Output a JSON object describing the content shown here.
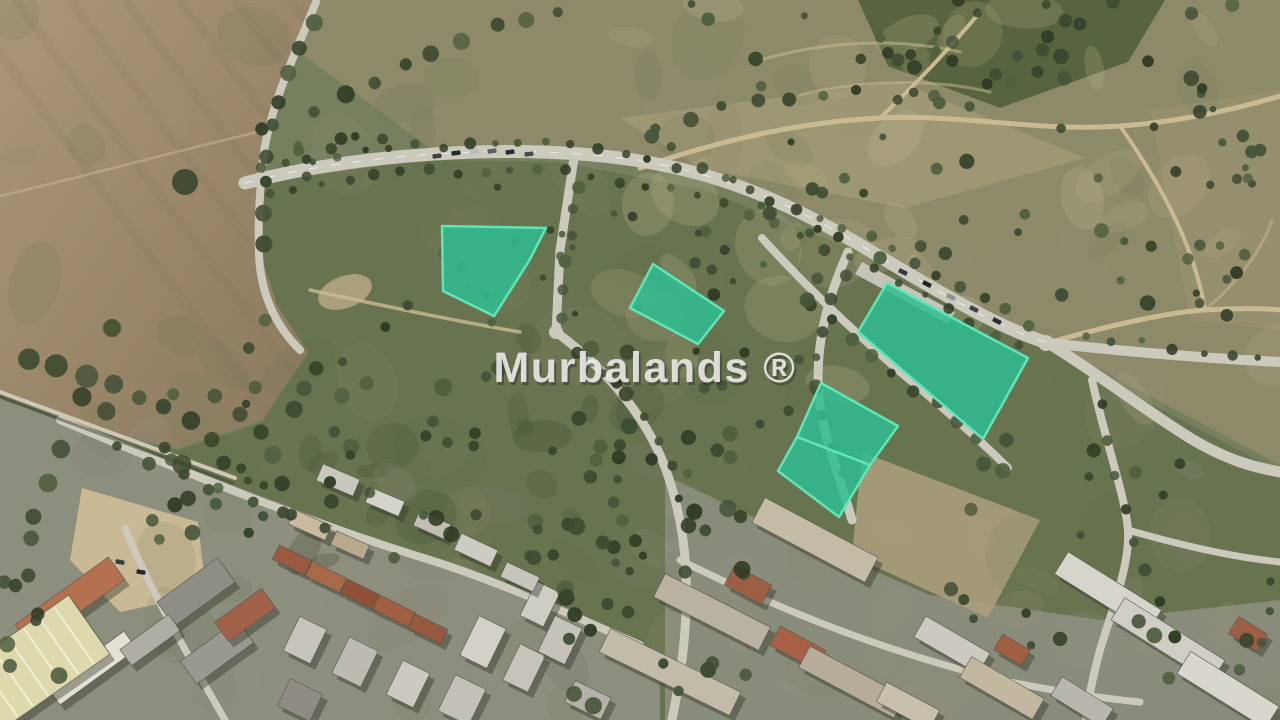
{
  "page": {
    "type": "aerial-satellite-parcel-listing-image",
    "description_visible_text_only": true
  },
  "watermark": {
    "text": "Murbalands ®",
    "color": "#ebebe8",
    "shadow_color": "#2f332e"
  },
  "map": {
    "imagery": "satellite",
    "highlight": {
      "fill": "#2fbd92",
      "fill_opacity": 0.85,
      "stroke": "#5fe6b4",
      "stroke_width": 2.5
    },
    "parcels": [
      {
        "id": "parcel-1",
        "points": [
          [
            442,
            226
          ],
          [
            546,
            228
          ],
          [
            529,
            261
          ],
          [
            494,
            316
          ],
          [
            443,
            291
          ]
        ]
      },
      {
        "id": "parcel-2",
        "points": [
          [
            653,
            264
          ],
          [
            724,
            311
          ],
          [
            698,
            344
          ],
          [
            630,
            308
          ]
        ]
      },
      {
        "id": "parcel-3",
        "points": [
          [
            887,
            283
          ],
          [
            1028,
            358
          ],
          [
            983,
            439
          ],
          [
            858,
            332
          ]
        ]
      },
      {
        "id": "parcel-4",
        "points": [
          [
            821,
            383
          ],
          [
            898,
            426
          ],
          [
            870,
            465
          ],
          [
            797,
            437
          ]
        ]
      },
      {
        "id": "parcel-5",
        "points": [
          [
            797,
            437
          ],
          [
            870,
            465
          ],
          [
            839,
            517
          ],
          [
            778,
            471
          ]
        ]
      }
    ]
  }
}
